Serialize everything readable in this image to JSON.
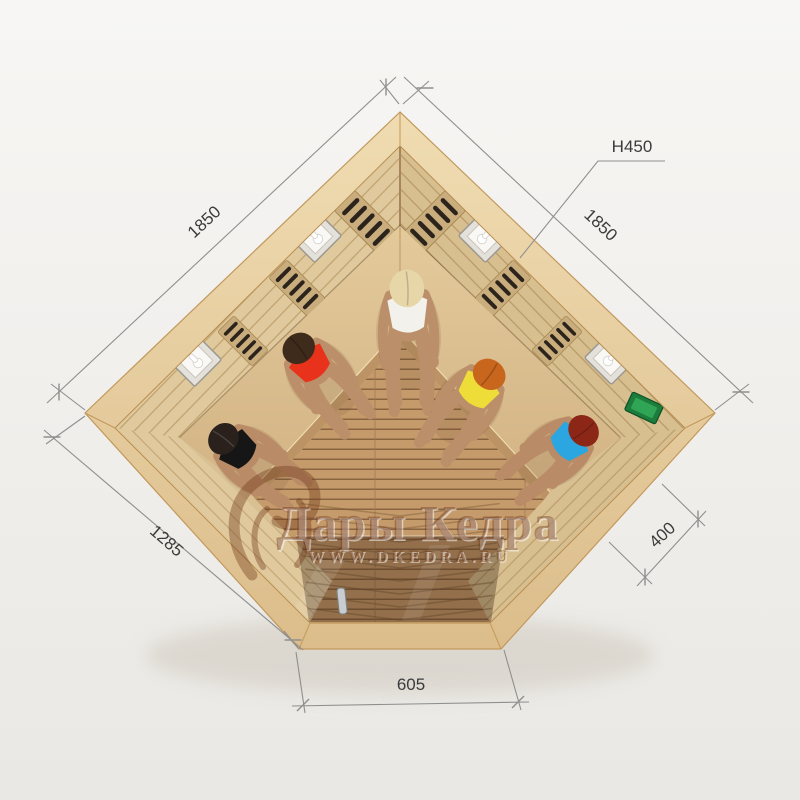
{
  "watermark": {
    "brand": "Дары Кедра",
    "url": "WWW.DKEDRA.RU",
    "ink": "#6e3517"
  },
  "dimensions": {
    "upper_left": "1850",
    "upper_right": "1850",
    "height": "H450",
    "lower_left": "1285",
    "lower_right": "400",
    "front": "605",
    "line_color": "#8f8f8f",
    "text_color": "#3b3b3b"
  },
  "palette": {
    "background_top": "#f7f6f4",
    "background_bottom": "#eae8e4",
    "rim_light": "#f0dcb2",
    "rim_dark": "#dcbd8b",
    "wall_left": "#e0c99c",
    "wall_right": "#d8bf90",
    "bench_light": "#e4ca9b",
    "bench_dark": "#d2b384",
    "floor": "#c59b6b",
    "floor_gap": "#8a6441",
    "heater_slot": "#2c241c",
    "glass_tint": "rgba(50,30,15,0.34)",
    "lamp_frame": "#e3e1da",
    "control_panel": "#1c7c3c",
    "control_screen": "#2fa555",
    "door_handle": "#c9cdcf"
  },
  "people": [
    {
      "position": "left-front",
      "hair": "#2a211c",
      "swimsuit": "#161616",
      "skin": "#b98c67"
    },
    {
      "position": "left-back",
      "hair": "#3f2b1b",
      "swimsuit": "#e8321c",
      "skin": "#bb8f6a"
    },
    {
      "position": "back-corner",
      "hair": "#e6d6a8",
      "swimsuit": "#f3f1ec",
      "skin": "#bb8f6a"
    },
    {
      "position": "right-back",
      "hair": "#c9661d",
      "swimsuit": "#eedd38",
      "skin": "#bb8f6a"
    },
    {
      "position": "right-front",
      "hair": "#8c2718",
      "swimsuit": "#2ba6e0",
      "skin": "#b98c67"
    }
  ]
}
